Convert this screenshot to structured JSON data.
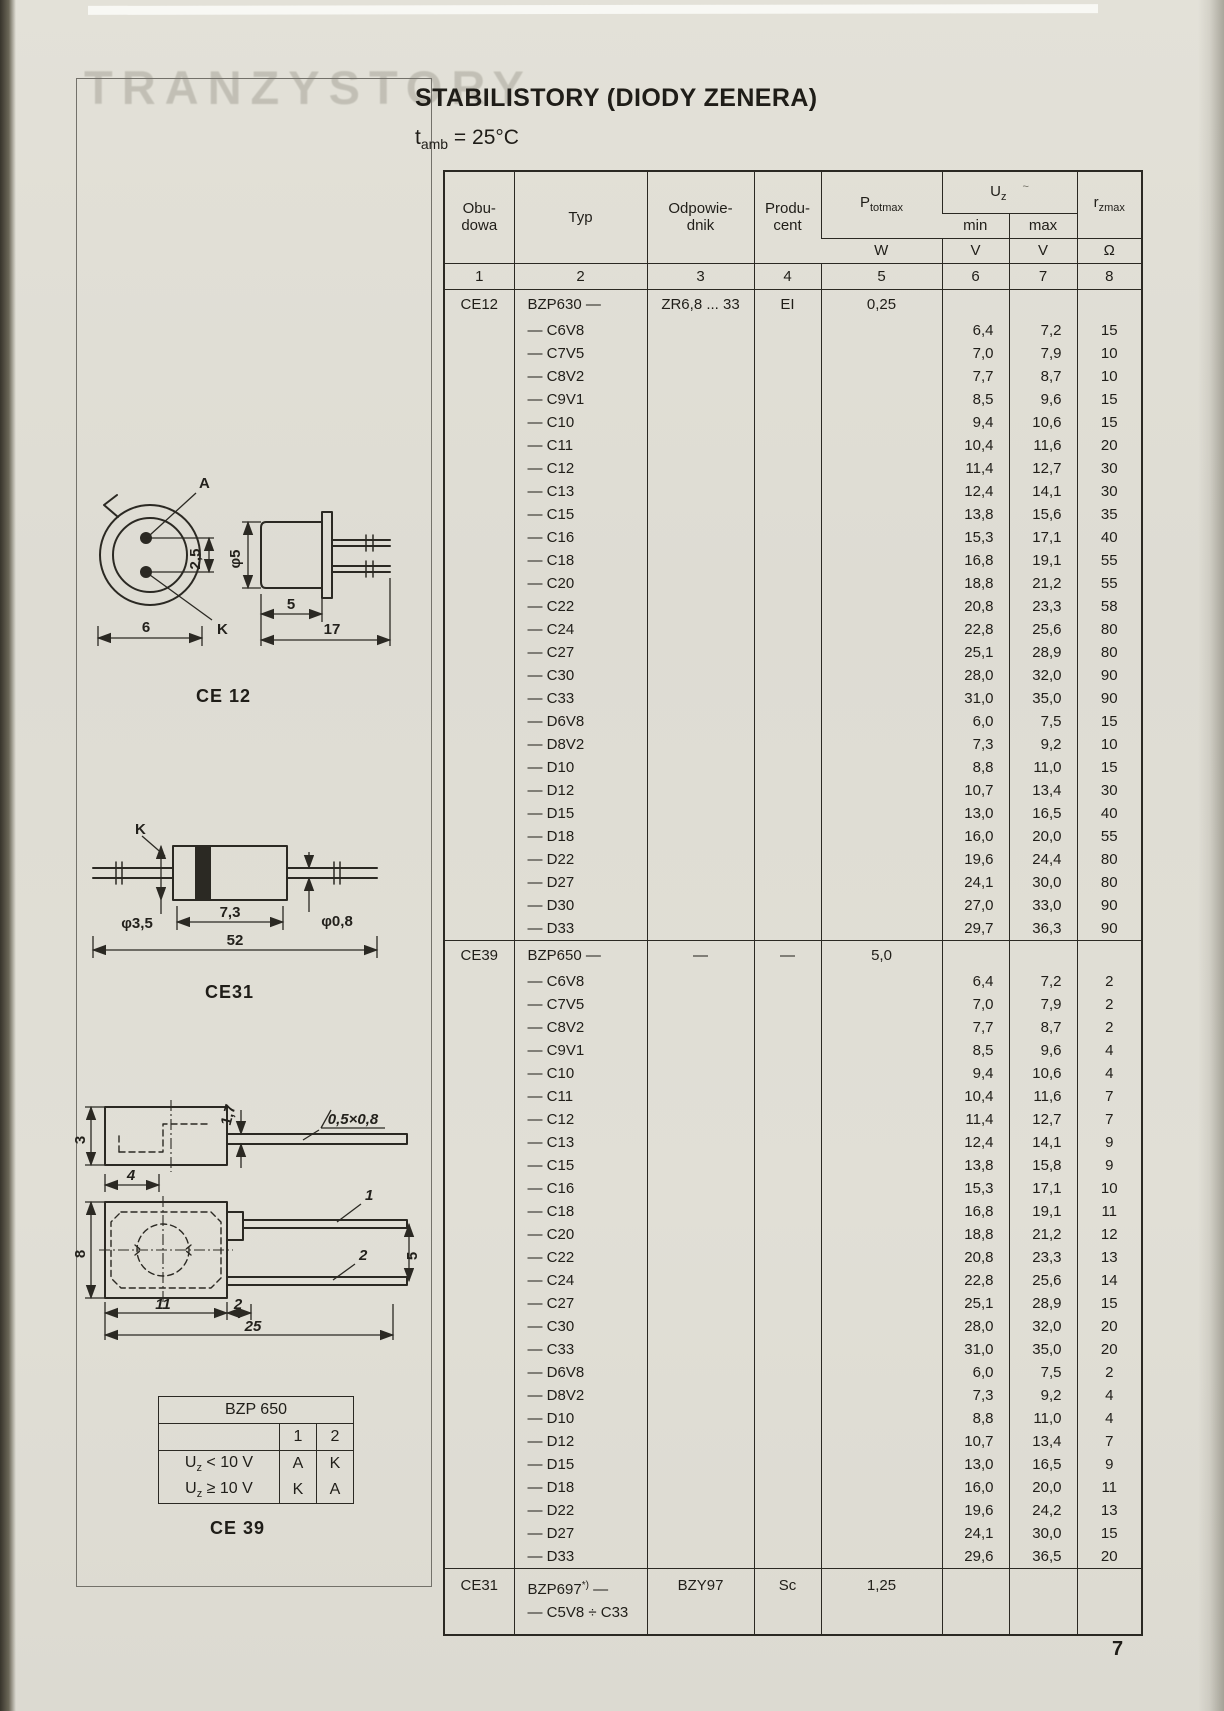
{
  "page": {
    "number": "7",
    "ghost_text": "TRANZYSTORY",
    "title": "STABILISTORY (DIODY ZENERA)",
    "subtitle": {
      "base": "t",
      "sub": "amb",
      "rest": " = 25°C"
    }
  },
  "table": {
    "headers": {
      "obudowa_l1": "Obu-",
      "obudowa_l2": "dowa",
      "typ": "Typ",
      "odpowiednik_l1": "Odpowie-",
      "odpowiednik_l2": "dnik",
      "producent_l1": "Produ-",
      "producent_l2": "cent",
      "ptot_base": "P",
      "ptot_sub": "totmax",
      "uz_base": "U",
      "uz_sub": "z",
      "uz_mark": "~",
      "min": "min",
      "max": "max",
      "rz_base": "r",
      "rz_sub": "zmax"
    },
    "units": [
      "W",
      "V",
      "V",
      "Ω"
    ],
    "col_numbers": [
      "1",
      "2",
      "3",
      "4",
      "5",
      "6",
      "7",
      "8"
    ],
    "sections": [
      {
        "obudowa": "CE12",
        "typ": "BZP630 —",
        "odpowiednik": "ZR6,8 ... 33",
        "producent": "EI",
        "ptotmax": "0,25",
        "rows_c": [
          {
            "typ": "— C6V8",
            "min": "6,4",
            "max": "7,2",
            "r": "15"
          },
          {
            "typ": "— C7V5",
            "min": "7,0",
            "max": "7,9",
            "r": "10"
          },
          {
            "typ": "— C8V2",
            "min": "7,7",
            "max": "8,7",
            "r": "10"
          },
          {
            "typ": "— C9V1",
            "min": "8,5",
            "max": "9,6",
            "r": "15"
          },
          {
            "typ": "— C10",
            "min": "9,4",
            "max": "10,6",
            "r": "15"
          },
          {
            "typ": "— C11",
            "min": "10,4",
            "max": "11,6",
            "r": "20"
          },
          {
            "typ": "— C12",
            "min": "11,4",
            "max": "12,7",
            "r": "30"
          },
          {
            "typ": "— C13",
            "min": "12,4",
            "max": "14,1",
            "r": "30"
          },
          {
            "typ": "— C15",
            "min": "13,8",
            "max": "15,6",
            "r": "35"
          },
          {
            "typ": "— C16",
            "min": "15,3",
            "max": "17,1",
            "r": "40"
          },
          {
            "typ": "— C18",
            "min": "16,8",
            "max": "19,1",
            "r": "55"
          },
          {
            "typ": "— C20",
            "min": "18,8",
            "max": "21,2",
            "r": "55"
          },
          {
            "typ": "— C22",
            "min": "20,8",
            "max": "23,3",
            "r": "58"
          },
          {
            "typ": "— C24",
            "min": "22,8",
            "max": "25,6",
            "r": "80"
          },
          {
            "typ": "— C27",
            "min": "25,1",
            "max": "28,9",
            "r": "80"
          },
          {
            "typ": "— C30",
            "min": "28,0",
            "max": "32,0",
            "r": "90"
          },
          {
            "typ": "— C33",
            "min": "31,0",
            "max": "35,0",
            "r": "90"
          }
        ],
        "rows_d": [
          {
            "typ": "— D6V8",
            "min": "6,0",
            "max": "7,5",
            "r": "15"
          },
          {
            "typ": "— D8V2",
            "min": "7,3",
            "max": "9,2",
            "r": "10"
          },
          {
            "typ": "— D10",
            "min": "8,8",
            "max": "11,0",
            "r": "15"
          },
          {
            "typ": "— D12",
            "min": "10,7",
            "max": "13,4",
            "r": "30"
          },
          {
            "typ": "— D15",
            "min": "13,0",
            "max": "16,5",
            "r": "40"
          },
          {
            "typ": "— D18",
            "min": "16,0",
            "max": "20,0",
            "r": "55"
          },
          {
            "typ": "— D22",
            "min": "19,6",
            "max": "24,4",
            "r": "80"
          },
          {
            "typ": "— D27",
            "min": "24,1",
            "max": "30,0",
            "r": "80"
          },
          {
            "typ": "— D30",
            "min": "27,0",
            "max": "33,0",
            "r": "90"
          },
          {
            "typ": "— D33",
            "min": "29,7",
            "max": "36,3",
            "r": "90"
          }
        ]
      },
      {
        "obudowa": "CE39",
        "typ": "BZP650 —",
        "odpowiednik": "—",
        "producent": "—",
        "ptotmax": "5,0",
        "rows_c": [
          {
            "typ": "— C6V8",
            "min": "6,4",
            "max": "7,2",
            "r": "2"
          },
          {
            "typ": "— C7V5",
            "min": "7,0",
            "max": "7,9",
            "r": "2"
          },
          {
            "typ": "— C8V2",
            "min": "7,7",
            "max": "8,7",
            "r": "2"
          },
          {
            "typ": "— C9V1",
            "min": "8,5",
            "max": "9,6",
            "r": "4"
          },
          {
            "typ": "— C10",
            "min": "9,4",
            "max": "10,6",
            "r": "4"
          },
          {
            "typ": "— C11",
            "min": "10,4",
            "max": "11,6",
            "r": "7"
          },
          {
            "typ": "— C12",
            "min": "11,4",
            "max": "12,7",
            "r": "7"
          },
          {
            "typ": "— C13",
            "min": "12,4",
            "max": "14,1",
            "r": "9"
          },
          {
            "typ": "— C15",
            "min": "13,8",
            "max": "15,8",
            "r": "9"
          },
          {
            "typ": "— C16",
            "min": "15,3",
            "max": "17,1",
            "r": "10"
          },
          {
            "typ": "— C18",
            "min": "16,8",
            "max": "19,1",
            "r": "11"
          },
          {
            "typ": "— C20",
            "min": "18,8",
            "max": "21,2",
            "r": "12"
          },
          {
            "typ": "— C22",
            "min": "20,8",
            "max": "23,3",
            "r": "13"
          },
          {
            "typ": "— C24",
            "min": "22,8",
            "max": "25,6",
            "r": "14"
          },
          {
            "typ": "— C27",
            "min": "25,1",
            "max": "28,9",
            "r": "15"
          },
          {
            "typ": "— C30",
            "min": "28,0",
            "max": "32,0",
            "r": "20"
          },
          {
            "typ": "— C33",
            "min": "31,0",
            "max": "35,0",
            "r": "20"
          }
        ],
        "rows_d": [
          {
            "typ": "— D6V8",
            "min": "6,0",
            "max": "7,5",
            "r": "2"
          },
          {
            "typ": "— D8V2",
            "min": "7,3",
            "max": "9,2",
            "r": "4"
          },
          {
            "typ": "— D10",
            "min": "8,8",
            "max": "11,0",
            "r": "4"
          },
          {
            "typ": "— D12",
            "min": "10,7",
            "max": "13,4",
            "r": "7"
          },
          {
            "typ": "— D15",
            "min": "13,0",
            "max": "16,5",
            "r": "9"
          },
          {
            "typ": "— D18",
            "min": "16,0",
            "max": "20,0",
            "r": "11"
          },
          {
            "typ": "— D22",
            "min": "19,6",
            "max": "24,2",
            "r": "13"
          },
          {
            "typ": "— D27",
            "min": "24,1",
            "max": "30,0",
            "r": "15"
          },
          {
            "typ": "— D33",
            "min": "29,6",
            "max": "36,5",
            "r": "20"
          }
        ]
      },
      {
        "obudowa": "CE31",
        "typ_base": "BZP697",
        "typ_sup": "*)",
        "typ_tail": " —",
        "typ_line2": "— C5V8 ÷ C33",
        "odpowiednik": "BZY97",
        "producent": "Sc",
        "ptotmax": "1,25"
      }
    ]
  },
  "drawings": {
    "ce12": {
      "caption": "CE 12",
      "labels": {
        "a": "A",
        "k": "K",
        "width": "6",
        "pitch": "2,5",
        "dia": "φ5",
        "body": "5",
        "total": "17"
      }
    },
    "ce31": {
      "caption": "CE31",
      "labels": {
        "k": "K",
        "dia": "φ3,5",
        "body": "7,3",
        "lead_dia": "φ0,8",
        "total": "52"
      }
    },
    "ce39": {
      "caption": "CE 39",
      "labels": {
        "h1": "3",
        "lead_t": "1,7",
        "chamfer": "0,5×0,8",
        "w1": "4",
        "h2": "8",
        "w2": "11",
        "gap": "2",
        "total": "25",
        "pitch": "5",
        "pin1": "1",
        "pin2": "2"
      }
    },
    "polarity": {
      "title": "BZP 650",
      "col1": "1",
      "col2": "2",
      "row1": {
        "base": "U",
        "sub": "z",
        "rest": " < 10 V",
        "c1": "A",
        "c2": "K"
      },
      "row2": {
        "base": "U",
        "sub": "z",
        "rest": " ≥ 10 V",
        "c1": "K",
        "c2": "A"
      }
    }
  }
}
